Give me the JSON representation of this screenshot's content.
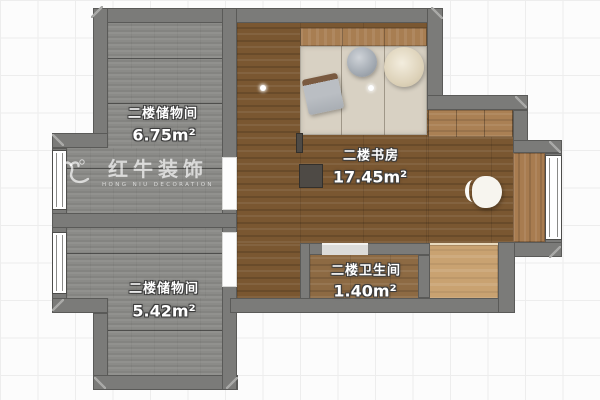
{
  "rooms": [
    {
      "id": "storage-top",
      "name": "二楼储物间",
      "area": "6.75m²"
    },
    {
      "id": "study",
      "name": "二楼书房",
      "area": "17.45m²"
    },
    {
      "id": "storage-bottom",
      "name": "二楼储物间",
      "area": "5.42m²"
    },
    {
      "id": "bathroom",
      "name": "二楼卫生间",
      "area": "1.40m²"
    }
  ],
  "watermark": {
    "brand": "红牛装饰",
    "subtitle": "HONG NIU DECORATION"
  },
  "icons": {
    "logo": "bull-logo-icon"
  },
  "colors": {
    "wall": "#7b7b79",
    "deck_floor": "#8b8b88",
    "study_floor": "#7a5731",
    "bath_floor": "#8d6a43",
    "cabinet_wood": "#c9a271",
    "tatami": "#d8d1c3",
    "headboard_wood": "#a87e52",
    "grid_background": "#fcfcfc"
  }
}
